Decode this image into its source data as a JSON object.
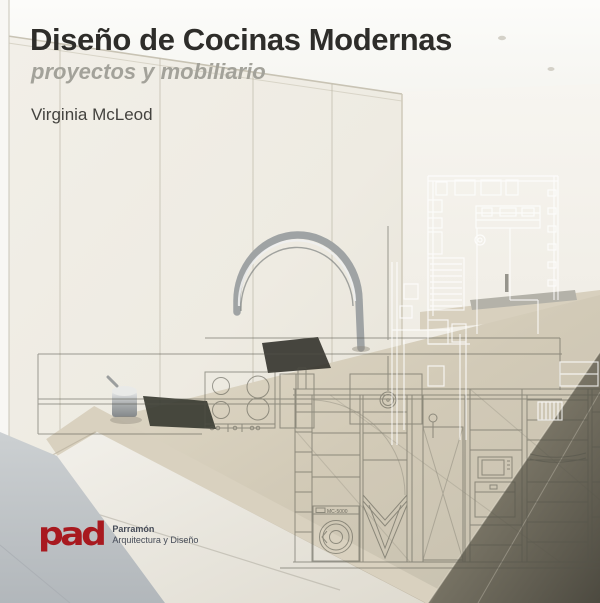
{
  "cover": {
    "title": "Diseño de Cocinas Modernas",
    "subtitle": "proyectos y mobiliario",
    "author": "Virginia McLeod",
    "publisher": {
      "logo_text": "pad",
      "name": "Parramón",
      "tagline": "Arquitectura y Diseño"
    },
    "colors": {
      "title_text": "#2e2d2a",
      "subtitle_text": "#a3a29a",
      "author_text": "#44433f",
      "logo_red": "#a8191f",
      "publisher_text": "#454b57",
      "cabinet_cream": "#f0ede5",
      "counter_beige": "#d5cdba",
      "floor_gray": "#c3c8cb",
      "plan_line_white": "#ffffff",
      "elevation_line_gray": "#54544a"
    },
    "drawing_labels": {
      "washer_model": "MC-5000"
    }
  }
}
